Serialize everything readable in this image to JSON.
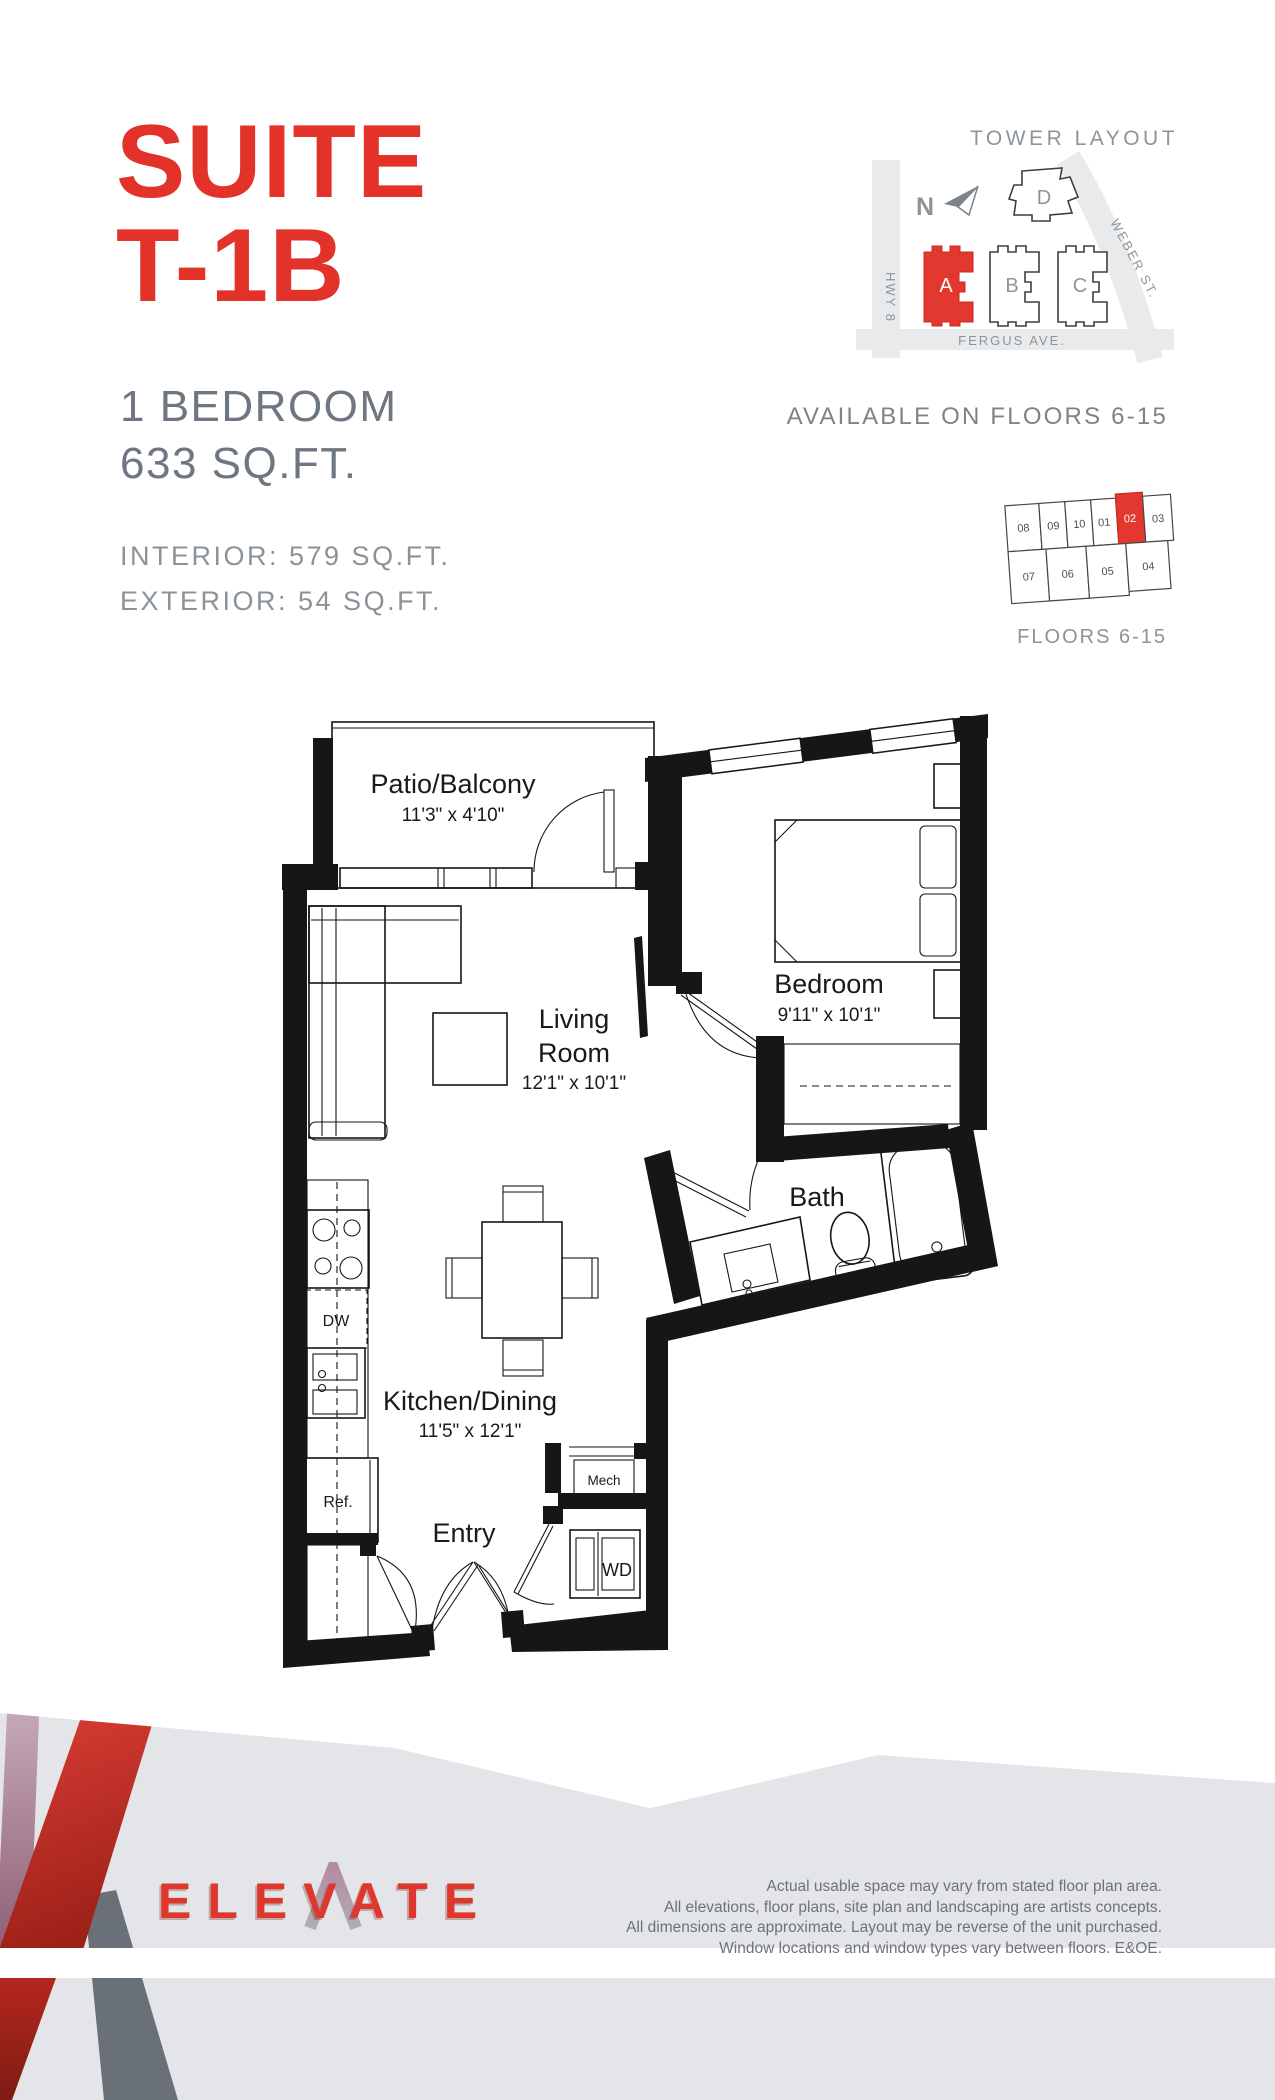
{
  "header": {
    "title_line1": "SUITE",
    "title_line2": "T-1B",
    "bedrooms": "1 BEDROOM",
    "area": "633 SQ.FT.",
    "interior": "INTERIOR: 579 SQ.FT.",
    "exterior": "EXTERIOR: 54 SQ.FT."
  },
  "tower_layout": {
    "title": "TOWER LAYOUT",
    "north": "N",
    "roads": {
      "hwy8": "HWY 8",
      "weber": "WEBER ST.",
      "fergus": "FERGUS AVE."
    },
    "buildings": [
      {
        "label": "A"
      },
      {
        "label": "B"
      },
      {
        "label": "C"
      },
      {
        "label": "D"
      }
    ]
  },
  "availability": {
    "headline": "AVAILABLE ON FLOORS 6-15",
    "floors_caption": "FLOORS 6-15"
  },
  "floor_plate": {
    "highlighted": "02",
    "units": [
      {
        "no": "08"
      },
      {
        "no": "09"
      },
      {
        "no": "10"
      },
      {
        "no": "01"
      },
      {
        "no": "02"
      },
      {
        "no": "03"
      },
      {
        "no": "07"
      },
      {
        "no": "06"
      },
      {
        "no": "05"
      },
      {
        "no": "04"
      }
    ]
  },
  "plan": {
    "patio": {
      "name": "Patio/Balcony",
      "dims": "11'3\" x 4'10\""
    },
    "living": {
      "line1": "Living",
      "line2": "Room",
      "dims": "12'1\" x 10'1\""
    },
    "bedroom": {
      "name": "Bedroom",
      "dims": "9'11\" x 10'1\""
    },
    "bath": {
      "name": "Bath"
    },
    "kitchen": {
      "name": "Kitchen/Dining",
      "dims": "11'5\" x 12'1\""
    },
    "entry": {
      "name": "Entry"
    },
    "appliances": {
      "dw": "DW",
      "ref": "Ref.",
      "mech": "Mech",
      "wd": "WD"
    }
  },
  "footer": {
    "logo": "ELEVATE",
    "disclaimer": [
      "Actual usable space may vary from stated floor plan area.",
      "All elevations, floor plans, site plan and landscaping are artists concepts.",
      "All dimensions are approximate. Layout may be reverse of the unit purchased.",
      "Window locations and window types vary between floors. E&OE."
    ]
  },
  "colors": {
    "brand_red": "#e23229",
    "text_gray": "#6d7681",
    "caption_gray": "#8b9399",
    "plan_black": "#161616",
    "band_gray": "#e3e5e8",
    "slate": "#6a7077"
  }
}
